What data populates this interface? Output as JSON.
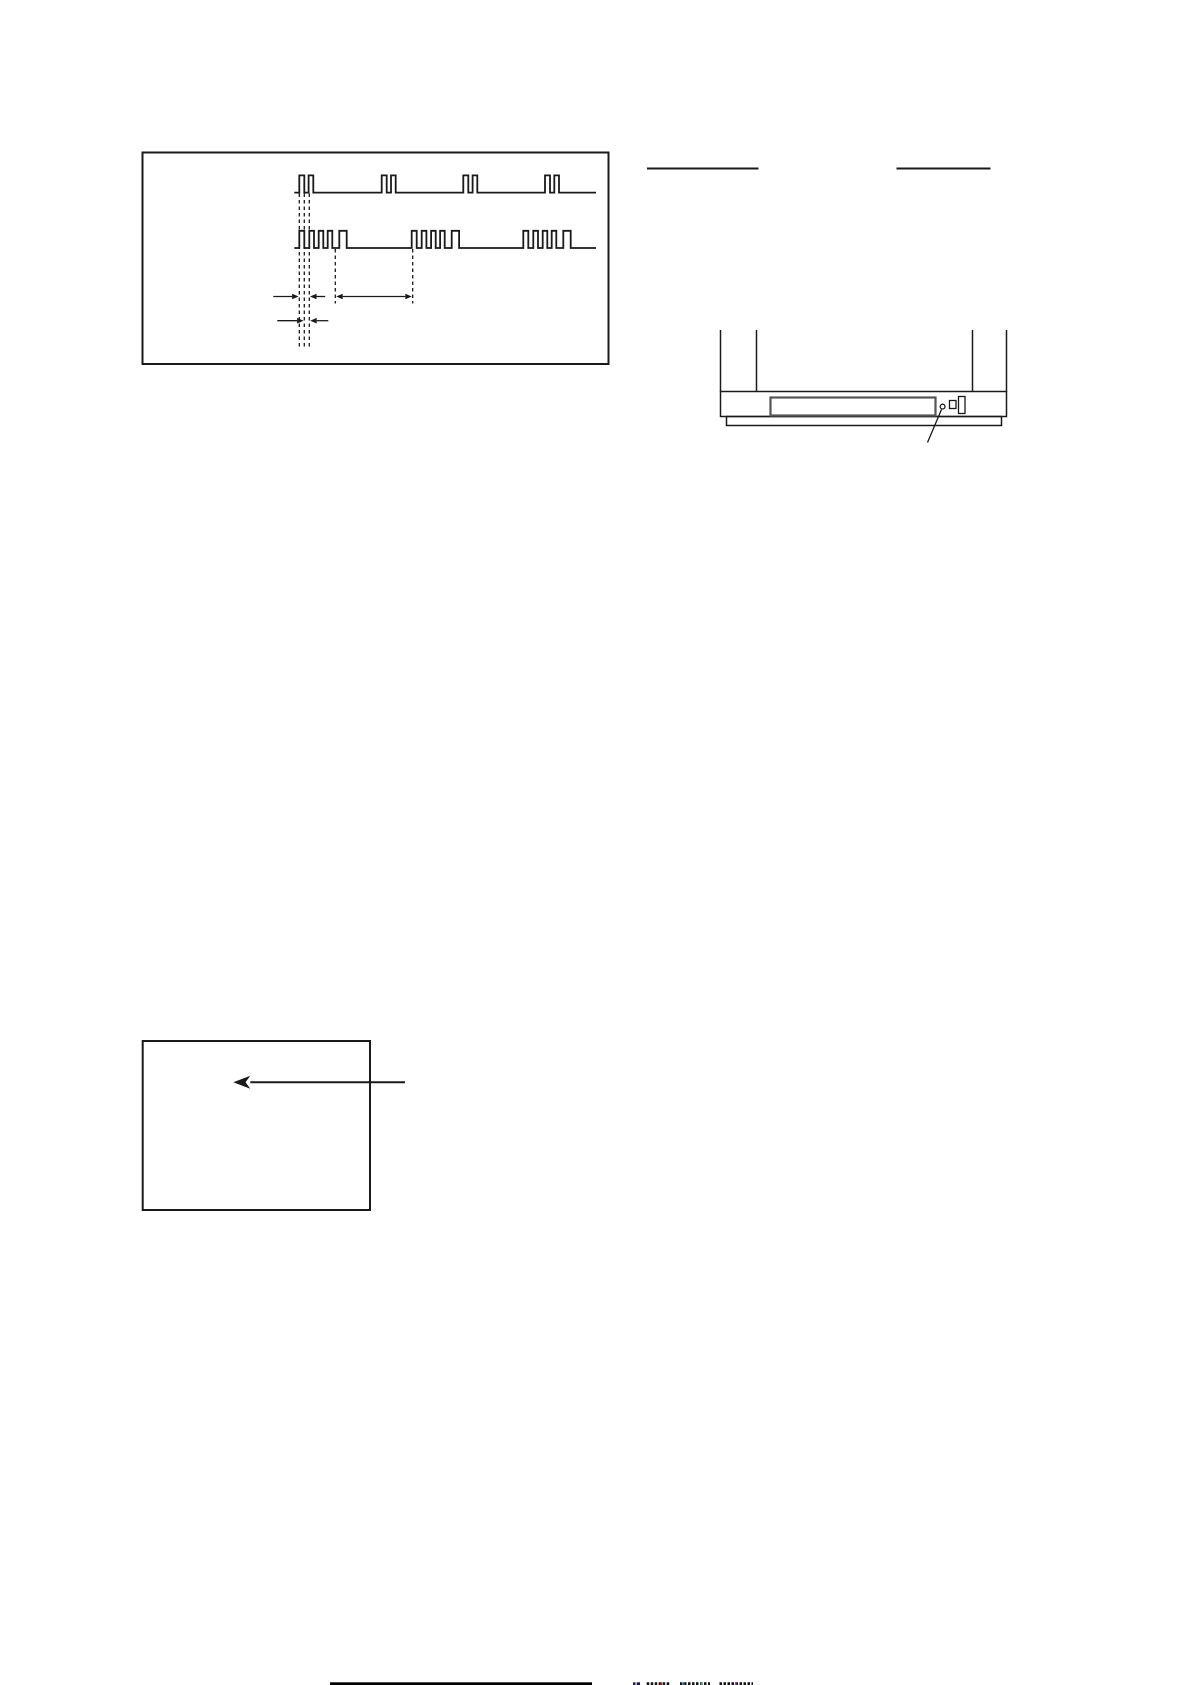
{
  "canvas": {
    "width": 1191,
    "height": 1685,
    "background": "#ffffff",
    "ink": "#1a1a1a"
  },
  "artwork": {
    "primitives": [
      {
        "name": "timing-diagram-frame",
        "type": "rect",
        "x": 142.5,
        "y": 152.5,
        "w": 466,
        "h": 211.5,
        "sw": 2
      },
      {
        "name": "signal-waveform-top",
        "type": "wave",
        "x0": 294.3,
        "x1": 596,
        "base": 192.6,
        "top": 175.4,
        "sw": 1.8,
        "groups": [
          299.3,
          381.7,
          463.3,
          545
        ],
        "pulses": [
          [
            0,
            5
          ],
          [
            9.3,
            14
          ]
        ]
      },
      {
        "name": "signal-waveform-bottom",
        "type": "wave",
        "x0": 294.3,
        "x1": 596,
        "base": 248,
        "top": 230.8,
        "sw": 1.8,
        "groups": [
          299.3,
          411.7,
          523.3
        ],
        "pulses": [
          [
            0,
            5
          ],
          [
            10,
            14.7
          ],
          [
            19.4,
            24
          ],
          [
            28.4,
            33
          ],
          [
            40,
            47.4
          ]
        ]
      },
      {
        "name": "dashed-guide-pulse-rise-1",
        "type": "line",
        "x1": 299.3,
        "y1": 193.5,
        "x2": 299.3,
        "y2": 349,
        "dash": "3.5 3",
        "sw": 1.3
      },
      {
        "name": "dashed-guide-pulse-fall-1",
        "type": "line",
        "x1": 304.3,
        "y1": 193.5,
        "x2": 304.3,
        "y2": 349,
        "dash": "3.5 3",
        "sw": 1.3
      },
      {
        "name": "dashed-guide-pulse-rise-2",
        "type": "line",
        "x1": 309.3,
        "y1": 193.5,
        "x2": 309.3,
        "y2": 349,
        "dash": "3.5 3",
        "sw": 1.3
      },
      {
        "name": "dashed-guide-group-end",
        "type": "line",
        "x1": 335.3,
        "y1": 249,
        "x2": 335.3,
        "y2": 303.5,
        "dash": "3.5 3",
        "sw": 1.3
      },
      {
        "name": "dashed-guide-group-start",
        "type": "line",
        "x1": 412.7,
        "y1": 249,
        "x2": 412.7,
        "y2": 303.5,
        "dash": "3.5 3",
        "sw": 1.3
      },
      {
        "name": "measure-arrow-period-left",
        "type": "arrow",
        "x1": 273.3,
        "x2": 298.6,
        "y": 296.5,
        "sw": 1.3
      },
      {
        "name": "measure-arrow-period-right",
        "type": "arrow",
        "x1": 325.2,
        "x2": 310.0,
        "y": 296.5,
        "sw": 1.3
      },
      {
        "name": "measure-arrow-interval",
        "type": "arrow",
        "x1": 336.2,
        "x2": 411.8,
        "y": 296.5,
        "both": true,
        "sw": 1.3
      },
      {
        "name": "measure-arrow-width-left",
        "type": "arrow",
        "x1": 277.3,
        "x2": 303.6,
        "y": 320.7,
        "sw": 1.3
      },
      {
        "name": "measure-arrow-width-right",
        "type": "arrow",
        "x1": 328.3,
        "x2": 310.2,
        "y": 320.7,
        "sw": 1.3
      },
      {
        "name": "reference-underline-left",
        "type": "line",
        "x1": 647.0,
        "y1": 168.5,
        "x2": 758.5,
        "y2": 168.5,
        "sw": 2
      },
      {
        "name": "reference-underline-right",
        "type": "line",
        "x1": 896.5,
        "y1": 168.5,
        "x2": 990.5,
        "y2": 168.5,
        "sw": 2
      },
      {
        "name": "tv-cabinet-side-left-outer",
        "type": "line",
        "x1": 720.5,
        "y1": 330,
        "x2": 720.5,
        "y2": 391.5,
        "sw": 1.5
      },
      {
        "name": "tv-cabinet-side-left-inner",
        "type": "line",
        "x1": 756.5,
        "y1": 330,
        "x2": 756.5,
        "y2": 391.5,
        "sw": 1.5
      },
      {
        "name": "tv-cabinet-side-right-inner",
        "type": "line",
        "x1": 972.5,
        "y1": 330,
        "x2": 972.5,
        "y2": 391.5,
        "sw": 1.5
      },
      {
        "name": "tv-cabinet-side-right-outer",
        "type": "line",
        "x1": 1006.5,
        "y1": 330,
        "x2": 1006.5,
        "y2": 391.5,
        "sw": 1.5
      },
      {
        "name": "tv-front-panel",
        "type": "rect",
        "x": 720.5,
        "y": 391.5,
        "w": 286,
        "h": 25,
        "sw": 1.5
      },
      {
        "name": "tv-base",
        "type": "rect",
        "x": 726.5,
        "y": 416.5,
        "w": 275,
        "h": 9,
        "sw": 1.5
      },
      {
        "name": "tv-panel-slot",
        "type": "rect",
        "x": 770.5,
        "y": 397.5,
        "w": 165,
        "h": 18,
        "sw": 2.2,
        "stroke": "#555555"
      },
      {
        "name": "tv-indicator-led",
        "type": "circle",
        "cx": 942.6,
        "cy": 406.6,
        "r": 2.4,
        "sw": 1.3
      },
      {
        "name": "tv-button-small",
        "type": "rect",
        "x": 949.5,
        "y": 400.5,
        "w": 6.5,
        "h": 8,
        "sw": 1.3
      },
      {
        "name": "tv-button-tall",
        "type": "rect",
        "x": 958.5,
        "y": 396.5,
        "w": 6.5,
        "h": 17,
        "sw": 1.3
      },
      {
        "name": "tv-callout-line",
        "type": "line",
        "x1": 941.5,
        "y1": 409.5,
        "x2": 927.5,
        "y2": 442.5,
        "sw": 1.3
      },
      {
        "name": "screen-frame",
        "type": "rect",
        "x": 142.7,
        "y": 1041,
        "w": 227.3,
        "h": 169,
        "sw": 2
      },
      {
        "name": "screen-arrow",
        "type": "arrow",
        "x1": 405,
        "x2": 233.3,
        "y": 1082.3,
        "len": 17,
        "half": 6.5,
        "barb": true,
        "sw": 2
      },
      {
        "name": "page-edge-bar",
        "type": "rect",
        "x": 330,
        "y": 1682.3,
        "w": 262,
        "h": 2.9,
        "fill": "#000000"
      },
      {
        "name": "page-edge-mark-0",
        "type": "line",
        "x1": 633.0,
        "y1": 1683.7,
        "x2": 635.5,
        "y2": 1683.7,
        "sw": 2.8,
        "stroke": "#22223a"
      },
      {
        "name": "page-edge-mark-1",
        "type": "line",
        "x1": 636.7,
        "y1": 1683.7,
        "x2": 640.0,
        "y2": 1683.7,
        "sw": 2.8,
        "stroke": "#1a1a3a"
      },
      {
        "name": "page-edge-mark-2",
        "type": "line",
        "x1": 646.7,
        "y1": 1683.7,
        "x2": 670.0,
        "y2": 1683.7,
        "sw": 2.8,
        "dash": "2.5 1.5",
        "stroke": "#111111"
      },
      {
        "name": "page-edge-mark-3",
        "type": "line",
        "x1": 680.0,
        "y1": 1683.7,
        "x2": 710.0,
        "y2": 1683.7,
        "sw": 2.8,
        "dash": "2.5 1.5",
        "stroke": "#111111"
      },
      {
        "name": "page-edge-mark-4",
        "type": "line",
        "x1": 719.5,
        "y1": 1683.7,
        "x2": 753.0,
        "y2": 1683.7,
        "sw": 2.8,
        "dash": "2.5 1.5",
        "stroke": "#111111"
      },
      {
        "name": "page-edge-fringe-red",
        "type": "rect",
        "x": 660.5,
        "y": 1682.3,
        "w": 1.6,
        "h": 2.9,
        "fill": "#bb2222"
      },
      {
        "name": "page-edge-fringe-blue",
        "type": "rect",
        "x": 683.0,
        "y": 1682.3,
        "w": 1.6,
        "h": 2.9,
        "fill": "#2266a0"
      },
      {
        "name": "page-edge-fringe-green",
        "type": "rect",
        "x": 700.5,
        "y": 1682.3,
        "w": 1.6,
        "h": 2.9,
        "fill": "#33a060"
      },
      {
        "name": "page-edge-fringe-magenta",
        "type": "rect",
        "x": 735.0,
        "y": 1682.3,
        "w": 1.6,
        "h": 2.9,
        "fill": "#a033a0"
      }
    ]
  }
}
